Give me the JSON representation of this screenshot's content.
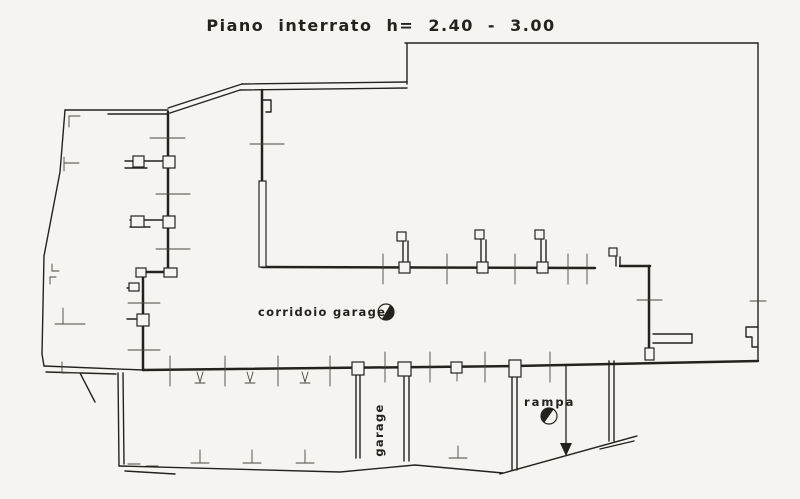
{
  "title": "Piano interrato  h= 2.40 - 3.00",
  "labels": {
    "corridor": "corridoio garages",
    "garage": "garage",
    "ramp": "rampa"
  },
  "colors": {
    "paper": "#f5f4f0",
    "ink": "#25221e",
    "ink_soft": "#4a463f"
  },
  "floor_plan": {
    "width": 800,
    "height": 499,
    "heavy_walls": [
      [
        168,
        112,
        168,
        270
      ],
      [
        140,
        272,
        176,
        272
      ],
      [
        143,
        276,
        143,
        370
      ],
      [
        262,
        90,
        262,
        181
      ],
      [
        262,
        267,
        595,
        268
      ],
      [
        620,
        266,
        650,
        266
      ],
      [
        649,
        266,
        649,
        359
      ],
      [
        143,
        370,
        515,
        366
      ],
      [
        515,
        366,
        758,
        361
      ]
    ],
    "medium_walls": [
      [
        405,
        43,
        758,
        43
      ],
      [
        758,
        43,
        758,
        360
      ],
      [
        407,
        44,
        407,
        84
      ],
      [
        407,
        82,
        242,
        84
      ],
      [
        407,
        88,
        240,
        90
      ],
      [
        242,
        84,
        168,
        108
      ],
      [
        240,
        90,
        170,
        113
      ],
      [
        65,
        110,
        168,
        110
      ],
      [
        108,
        114,
        168,
        114
      ],
      [
        44,
        366,
        143,
        370
      ],
      [
        46,
        372,
        116,
        374
      ],
      [
        80,
        373,
        95,
        402
      ],
      [
        118,
        373,
        119,
        466
      ],
      [
        123,
        373,
        124,
        464
      ],
      [
        125,
        471,
        175,
        474
      ],
      [
        356,
        375,
        356,
        458
      ],
      [
        360,
        375,
        360,
        458
      ],
      [
        404,
        377,
        404,
        461
      ],
      [
        409,
        377,
        409,
        461
      ],
      [
        512,
        377,
        512,
        470
      ],
      [
        517,
        377,
        517,
        470
      ],
      [
        609,
        361,
        609,
        441
      ],
      [
        614,
        361,
        614,
        441
      ],
      [
        500,
        474,
        637,
        436
      ],
      [
        600,
        449,
        634,
        441
      ],
      [
        653,
        334,
        692,
        334
      ],
      [
        653,
        343,
        692,
        343
      ],
      [
        692,
        334,
        692,
        343
      ],
      [
        403,
        241,
        403,
        263
      ],
      [
        408,
        241,
        408,
        263
      ],
      [
        481,
        240,
        481,
        263
      ],
      [
        486,
        240,
        486,
        263
      ],
      [
        541,
        240,
        541,
        263
      ],
      [
        546,
        240,
        546,
        263
      ],
      [
        616,
        257,
        616,
        266
      ],
      [
        620,
        257,
        620,
        266
      ],
      [
        125,
        161,
        164,
        161
      ],
      [
        125,
        168,
        147,
        168
      ],
      [
        130,
        220,
        164,
        220
      ],
      [
        130,
        227,
        150,
        227
      ],
      [
        127,
        288,
        138,
        288
      ],
      [
        127,
        319,
        137,
        319
      ]
    ],
    "polylines": [
      [
        [
          65,
          110
        ],
        [
          60,
          172
        ],
        [
          44,
          256
        ],
        [
          42,
          354
        ],
        [
          44,
          366
        ]
      ],
      [
        [
          119,
          466
        ],
        [
          340,
          472
        ],
        [
          415,
          465
        ],
        [
          503,
          473
        ]
      ],
      [
        [
          758,
          327
        ],
        [
          746,
          327
        ],
        [
          746,
          337
        ],
        [
          752,
          337
        ],
        [
          752,
          347
        ],
        [
          758,
          347
        ]
      ],
      [
        [
          262,
          100
        ],
        [
          271,
          100
        ],
        [
          271,
          112
        ],
        [
          266,
          112
        ]
      ]
    ],
    "thin_lines": [
      [
        383,
        254,
        383,
        284
      ],
      [
        447,
        254,
        447,
        284
      ],
      [
        515,
        254,
        515,
        284
      ],
      [
        568,
        254,
        568,
        284
      ],
      [
        587,
        254,
        587,
        284
      ],
      [
        170,
        356,
        170,
        386
      ],
      [
        225,
        356,
        225,
        386
      ],
      [
        278,
        356,
        278,
        386
      ],
      [
        330,
        356,
        330,
        386
      ],
      [
        385,
        352,
        385,
        382
      ],
      [
        430,
        352,
        430,
        382
      ],
      [
        485,
        352,
        485,
        382
      ],
      [
        550,
        352,
        550,
        382
      ],
      [
        150,
        138,
        185,
        138
      ],
      [
        156,
        194,
        190,
        194
      ],
      [
        156,
        249,
        190,
        249
      ],
      [
        128,
        303,
        160,
        303
      ],
      [
        128,
        350,
        160,
        350
      ],
      [
        250,
        144,
        284,
        144
      ],
      [
        637,
        300,
        662,
        300
      ],
      [
        750,
        301,
        766,
        301
      ],
      [
        197,
        372,
        200,
        382
      ],
      [
        203,
        372,
        200,
        382
      ],
      [
        195,
        383,
        205,
        383
      ],
      [
        247,
        372,
        250,
        382
      ],
      [
        253,
        372,
        250,
        382
      ],
      [
        245,
        383,
        255,
        383
      ],
      [
        302,
        372,
        305,
        382
      ],
      [
        308,
        372,
        305,
        382
      ],
      [
        300,
        383,
        310,
        383
      ],
      [
        457,
        373,
        457,
        381
      ],
      [
        200,
        450,
        200,
        462
      ],
      [
        191,
        463,
        209,
        463
      ],
      [
        252,
        450,
        252,
        462
      ],
      [
        243,
        463,
        261,
        463
      ],
      [
        305,
        450,
        305,
        462
      ],
      [
        296,
        463,
        314,
        463
      ],
      [
        458,
        446,
        458,
        457
      ],
      [
        449,
        458,
        467,
        458
      ],
      [
        128,
        464,
        140,
        464
      ],
      [
        146,
        466,
        158,
        466
      ],
      [
        69,
        116,
        80,
        116
      ],
      [
        69,
        116,
        69,
        127
      ],
      [
        64,
        157,
        64,
        171
      ],
      [
        64,
        163,
        79,
        163
      ],
      [
        52,
        264,
        52,
        271
      ],
      [
        52,
        271,
        59,
        271
      ],
      [
        50,
        277,
        50,
        284
      ],
      [
        50,
        277,
        56,
        277
      ],
      [
        55,
        324,
        85,
        324
      ],
      [
        63,
        308,
        63,
        324
      ],
      [
        62,
        362,
        62,
        373
      ],
      [
        62,
        373,
        80,
        373
      ]
    ],
    "boxes": [
      [
        259,
        181,
        7,
        86
      ],
      [
        133,
        156,
        11,
        11
      ],
      [
        163,
        156,
        12,
        12
      ],
      [
        131,
        216,
        13,
        11
      ],
      [
        163,
        216,
        12,
        12
      ],
      [
        136,
        268,
        10,
        9
      ],
      [
        164,
        268,
        13,
        9
      ],
      [
        129,
        283,
        10,
        8
      ],
      [
        137,
        314,
        12,
        12
      ],
      [
        397,
        232,
        9,
        9
      ],
      [
        475,
        230,
        9,
        9
      ],
      [
        535,
        230,
        9,
        9
      ],
      [
        399,
        262,
        11,
        11
      ],
      [
        477,
        262,
        11,
        11
      ],
      [
        537,
        262,
        11,
        11
      ],
      [
        609,
        248,
        8,
        8
      ],
      [
        352,
        362,
        12,
        13
      ],
      [
        398,
        362,
        13,
        14
      ],
      [
        451,
        362,
        11,
        11
      ],
      [
        509,
        360,
        12,
        17
      ],
      [
        645,
        348,
        9,
        12
      ]
    ],
    "half_circles": [
      {
        "cx": 386,
        "cy": 312,
        "r": 8,
        "angle": 30
      },
      {
        "cx": 549,
        "cy": 416,
        "r": 8,
        "angle": 215
      }
    ],
    "arrow": {
      "line": [
        566,
        364,
        566,
        446
      ],
      "head": [
        [
          560,
          443
        ],
        [
          572,
          443
        ],
        [
          566,
          456
        ]
      ]
    }
  }
}
